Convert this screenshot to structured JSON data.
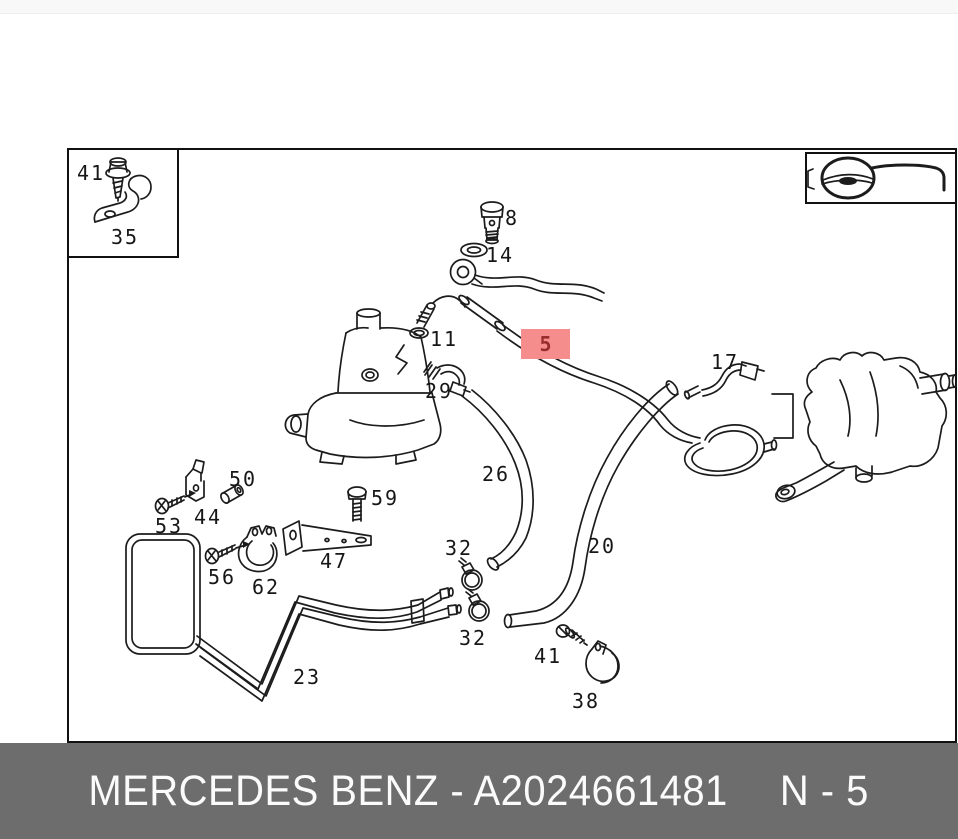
{
  "footer": {
    "brand_text": "MERCEDES BENZ - A2024661481",
    "page_code": "N - 5",
    "bg_color": "#6d6d6d",
    "text_color": "#fbfbfb"
  },
  "highlight": {
    "label": "5",
    "bg_color": "#f68d8d",
    "text_color": "#992d2d"
  },
  "icons": {
    "steering_wheel": "steering-wheel-with-column"
  },
  "parts": {
    "inset_screw": "41",
    "inset_bracket": "35",
    "banjo_bolt": "8",
    "seal_ring": "14",
    "o_ring": "11",
    "connector": "29",
    "pressure_hose": "5",
    "pipe_17": "17",
    "suction_hose": "26",
    "return_hose": "20",
    "clamp_32a": "32",
    "clamp_32b": "32",
    "sleeve": "50",
    "clip": "44",
    "screw_53": "53",
    "bolt_59": "59",
    "bracket_47": "47",
    "screw_56": "56",
    "clamp_62": "62",
    "cooler_pipe": "23",
    "screw_41b": "41",
    "clamp_38": "38"
  }
}
